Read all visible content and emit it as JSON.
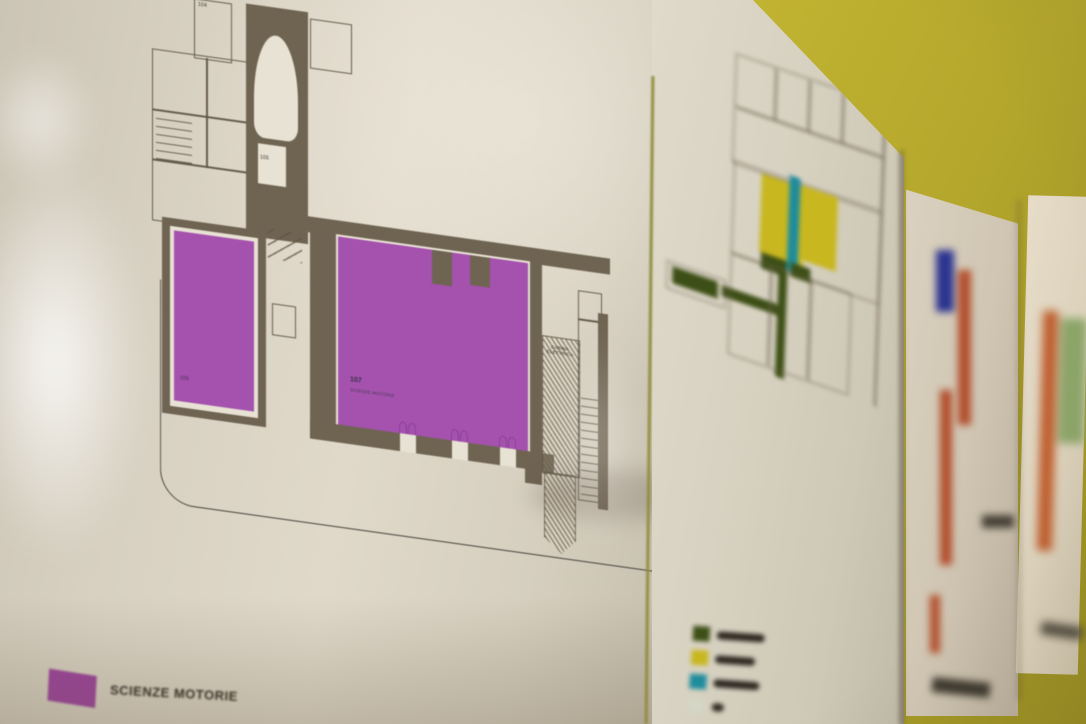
{
  "scene": {
    "type": "photograph",
    "description": "Color-coded school floor-plan posters taped in a row on a yellow wall, photographed at an angle with shallow depth of field; the nearest sheet is in focus, the others are increasingly blurred",
    "wall_color": "#c9bc34",
    "paper_color": "#d9d2c3"
  },
  "sheet1": {
    "plan": {
      "wall_color": "#6f6452",
      "highlight_color": "#a452ae",
      "labels": {
        "room104": "104",
        "room105": "105",
        "room106": "106",
        "room107": "107",
        "room107_name": "SCIENZE MOTORIE",
        "cabina_line1": "CABINA",
        "cabina_line2": "ELETTRICA"
      }
    },
    "legend": {
      "swatch_color": "#9b3f9b",
      "label": "SCIENZE MOTORIE"
    }
  },
  "sheet2": {
    "colors": {
      "yellow": "#c8b71f",
      "teal": "#1f8c9c",
      "green": "#3d4f16",
      "outline": "#6b5f4c"
    },
    "legend": [
      {
        "color": "#3d4f16"
      },
      {
        "color": "#c8b71f"
      },
      {
        "color": "#1f8c9c"
      },
      {
        "color": "#d4d6c6"
      }
    ]
  },
  "sheet3": {
    "colors": {
      "blue": "#2b3490",
      "red": "#b24e2c",
      "dark": "#474136"
    }
  },
  "sheet4": {
    "colors": {
      "orange": "#bf5e2e",
      "green": "#8ba468",
      "dark": "#554e40"
    }
  }
}
